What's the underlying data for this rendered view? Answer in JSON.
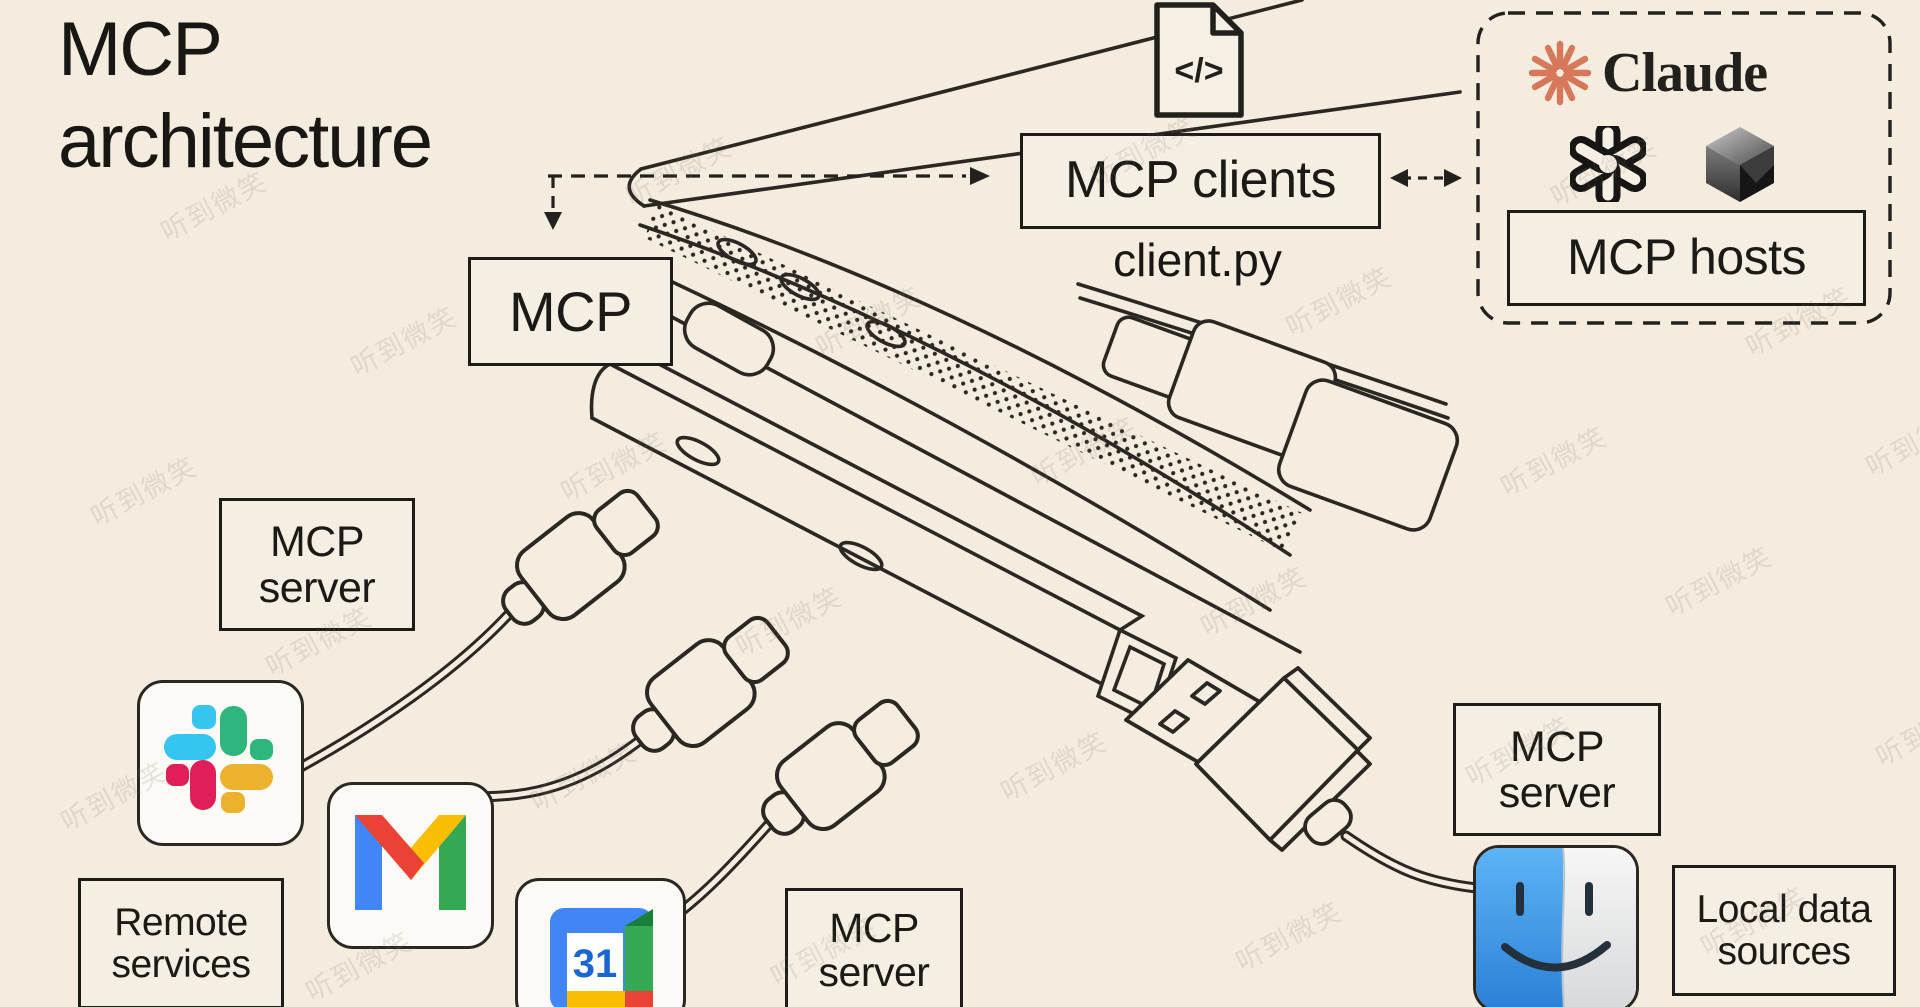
{
  "title": {
    "line1": "MCP",
    "line2": "architecture"
  },
  "client": {
    "file_glyph": "</>",
    "box_label": "MCP clients",
    "filename": "client.py"
  },
  "mcp_box": {
    "label": "MCP"
  },
  "hosts": {
    "claude_wordmark": "Claude",
    "box_label": "MCP hosts"
  },
  "servers": {
    "server1": {
      "line1": "MCP",
      "line2": "server"
    },
    "server2": {
      "line1": "MCP",
      "line2": "server"
    },
    "server3": {
      "line1": "MCP",
      "line2": "server"
    }
  },
  "sources": {
    "remote": {
      "line1": "Remote",
      "line2": "services"
    },
    "local": {
      "line1": "Local data",
      "line2": "sources"
    }
  },
  "logos": {
    "claude": "claude-starburst-icon",
    "openai": "openai-knot-icon",
    "cursor": "cursor-cube-icon",
    "slack": "slack-icon",
    "gmail": "gmail-icon",
    "calendar": "google-calendar-icon",
    "calendar_day": "31",
    "finder": "macos-finder-icon"
  },
  "colors": {
    "background": "#F3ECDF",
    "line": "#2B2824",
    "claude_orange": "#D7785A",
    "slack_blue": "#36C5F0",
    "slack_green": "#2EB67D",
    "slack_red": "#E01E5A",
    "slack_yellow": "#ECB22E",
    "google_blue": "#4285F4",
    "google_red": "#EA4335",
    "google_yellow": "#FBBC04",
    "google_green": "#34A853",
    "calendar_number_blue": "#1967D2",
    "finder_blue": "#3E9BE9"
  },
  "watermark": {
    "text": "听到微笑",
    "positions": [
      [
        155,
        185
      ],
      [
        620,
        150
      ],
      [
        1085,
        130
      ],
      [
        1545,
        150
      ],
      [
        345,
        320
      ],
      [
        810,
        300
      ],
      [
        1280,
        280
      ],
      [
        1740,
        300
      ],
      [
        85,
        470
      ],
      [
        555,
        445
      ],
      [
        1025,
        430
      ],
      [
        1495,
        440
      ],
      [
        1860,
        420
      ],
      [
        260,
        620
      ],
      [
        730,
        600
      ],
      [
        1195,
        580
      ],
      [
        1660,
        560
      ],
      [
        55,
        775
      ],
      [
        525,
        755
      ],
      [
        995,
        745
      ],
      [
        1460,
        730
      ],
      [
        1870,
        710
      ],
      [
        300,
        945
      ],
      [
        765,
        930
      ],
      [
        1230,
        915
      ],
      [
        1695,
        900
      ]
    ]
  }
}
